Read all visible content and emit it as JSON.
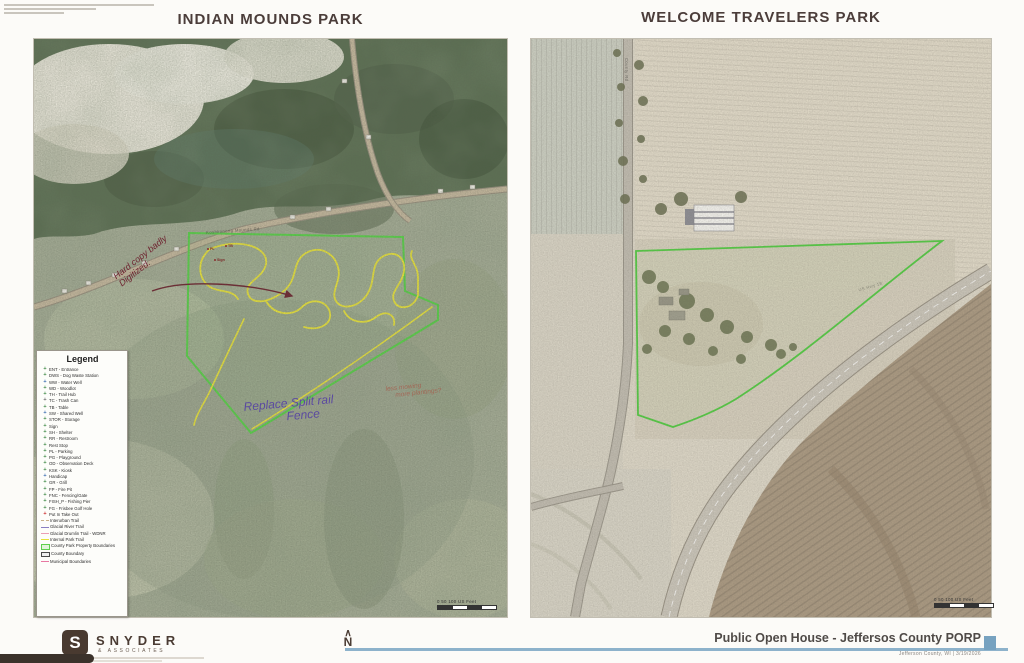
{
  "page": {
    "left_title": "INDIAN MOUNDS PARK",
    "right_title": "WELCOME TRAVELERS PARK"
  },
  "legend": {
    "title": "Legend",
    "items": [
      {
        "label": "ENT - Entrance",
        "marker": "point",
        "color": "#3f8a46"
      },
      {
        "label": "DWS - Dog Waste Station",
        "marker": "point",
        "color": "#3f8a46"
      },
      {
        "label": "WW - Water Well",
        "marker": "point",
        "color": "#3a6db0"
      },
      {
        "label": "WD - Woodlot",
        "marker": "point",
        "color": "#3f8a46"
      },
      {
        "label": "TH - Trail Hub",
        "marker": "point",
        "color": "#3f8a46"
      },
      {
        "label": "TC - Trash Can",
        "marker": "point",
        "color": "#6b6b6b"
      },
      {
        "label": "TB - Table",
        "marker": "point",
        "color": "#3f8a46"
      },
      {
        "label": "SW - Shared Well",
        "marker": "point",
        "color": "#3a6db0"
      },
      {
        "label": "STOR - Storage",
        "marker": "point",
        "color": "#3f8a46"
      },
      {
        "label": "Sign",
        "marker": "point",
        "color": "#3f8a46"
      },
      {
        "label": "SH - Shelter",
        "marker": "point",
        "color": "#3f8a46"
      },
      {
        "label": "RR - Restroom",
        "marker": "point",
        "color": "#3f8a46"
      },
      {
        "label": "Rest Stop",
        "marker": "point",
        "color": "#3f8a46"
      },
      {
        "label": "PL - Parking",
        "marker": "point",
        "color": "#3f8a46"
      },
      {
        "label": "PG - Playground",
        "marker": "point",
        "color": "#3f8a46"
      },
      {
        "label": "OD - Observation Deck",
        "marker": "point",
        "color": "#3f8a46"
      },
      {
        "label": "KSK - Kiosk",
        "marker": "point",
        "color": "#3f8a46"
      },
      {
        "label": "Handicap",
        "marker": "point",
        "color": "#3a6db0"
      },
      {
        "label": "GR - Grill",
        "marker": "point",
        "color": "#3f8a46"
      },
      {
        "label": "FP - Fire Pit",
        "marker": "point",
        "color": "#3f8a46"
      },
      {
        "label": "FNC - Fencing/Gate",
        "marker": "point",
        "color": "#3f8a46"
      },
      {
        "label": "FISH_P - Fishing Pier",
        "marker": "point",
        "color": "#3f8a46"
      },
      {
        "label": "FG - Frisbee Golf Hole",
        "marker": "point",
        "color": "#3f8a46"
      },
      {
        "label": "Put In Take Out",
        "marker": "point",
        "color": "#cc2b2b"
      },
      {
        "label": "Interurban Trail",
        "marker": "dash",
        "color": "#c9b188"
      },
      {
        "label": "Glacial River Trail",
        "marker": "line",
        "color": "#8a7fc2"
      },
      {
        "label": "Glacial Drumlin Trail - WDNR",
        "marker": "line",
        "color": "#ec9fb5"
      },
      {
        "label": "Internal Park Trail",
        "marker": "line",
        "color": "#e7e23b"
      },
      {
        "label": "County Park Property Boundaries",
        "marker": "box",
        "color": "#5ecf4d",
        "fill": "#e2f4da"
      },
      {
        "label": "County Boundary",
        "marker": "box",
        "color": "#4a4a4a",
        "fill": "#efefef"
      },
      {
        "label": "Municipal Boundaries",
        "marker": "line",
        "color": "#e878a2"
      }
    ]
  },
  "annotations": {
    "digitized_1": "Hard copy badly",
    "digitized_2": "Digitized.",
    "fence_1": "Replace Split rail",
    "fence_2": "Fence",
    "mowing_1": "less mowing",
    "mowing_2": "more plantings?"
  },
  "markers": {
    "m1": "PL",
    "m2": "TB",
    "m3": "Sign"
  },
  "roads": {
    "left_label": "Koshkonong Mounds Rd",
    "right_label": "County Rd",
    "highway_label": "US Hwy 18"
  },
  "scale": {
    "left": "0        50       100 US Feet",
    "right": "0        50       100 US Feet"
  },
  "footer": {
    "logo_letter": "S",
    "brand": "SNYDER",
    "brand_sub": "& ASSOCIATES",
    "north": "N",
    "north_roof": "∧",
    "title": "Public Open House - Jeffersos County PORP",
    "subtitle": "Jefferson County, WI | 3/19/2026"
  }
}
